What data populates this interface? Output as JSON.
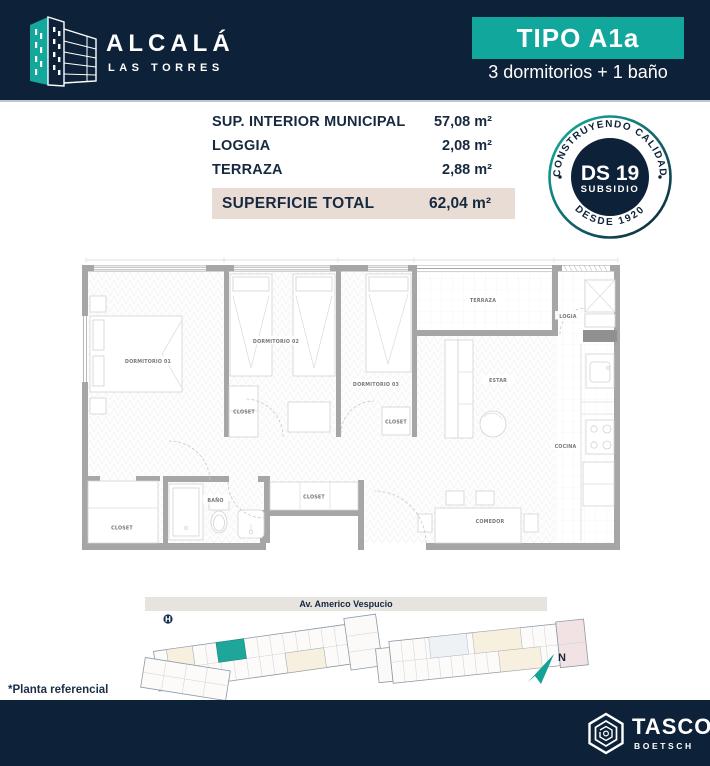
{
  "header": {
    "brand_name": "ALCALÁ",
    "brand_sub": "LAS TORRES",
    "type_label": "TIPO A1a",
    "subtitle": "3 dormitorios + 1 baño"
  },
  "surfaces": {
    "rows": [
      {
        "label": "SUP. INTERIOR MUNICIPAL",
        "value": "57,08 m²"
      },
      {
        "label": "LOGGIA",
        "value": "2,08 m²"
      },
      {
        "label": "TERRAZA",
        "value": "2,88 m²"
      }
    ],
    "total_label": "SUPERFICIE TOTAL",
    "total_value": "62,04 m²"
  },
  "seal": {
    "arc_top": "CONSTRUYENDO CALIDAD",
    "arc_bottom": "DESDE 1920",
    "center_line1": "DS 19",
    "center_line2": "SUBSIDIO"
  },
  "floorplan": {
    "rooms": {
      "dorm1": "DORMITORIO 01",
      "dorm2": "DORMITORIO 02",
      "dorm3": "DORMITORIO 03",
      "terraza": "TERRAZA",
      "logia": "LOGIA",
      "estar": "ESTAR",
      "cocina": "COCINA",
      "comedor": "COMEDOR",
      "bano": "BAÑO",
      "closet": "CLOSET"
    }
  },
  "siteplan": {
    "street": "Av. Americo Vespucio",
    "north": "N"
  },
  "footnote": "*Planta referencial",
  "footer": {
    "brand": "TASCO",
    "brand_sub": "BOETSCH"
  },
  "colors": {
    "navy": "#0d2138",
    "teal": "#12a79c",
    "total_row_bg": "#e9dcd4",
    "highlight_unit": "#1ea69a"
  }
}
